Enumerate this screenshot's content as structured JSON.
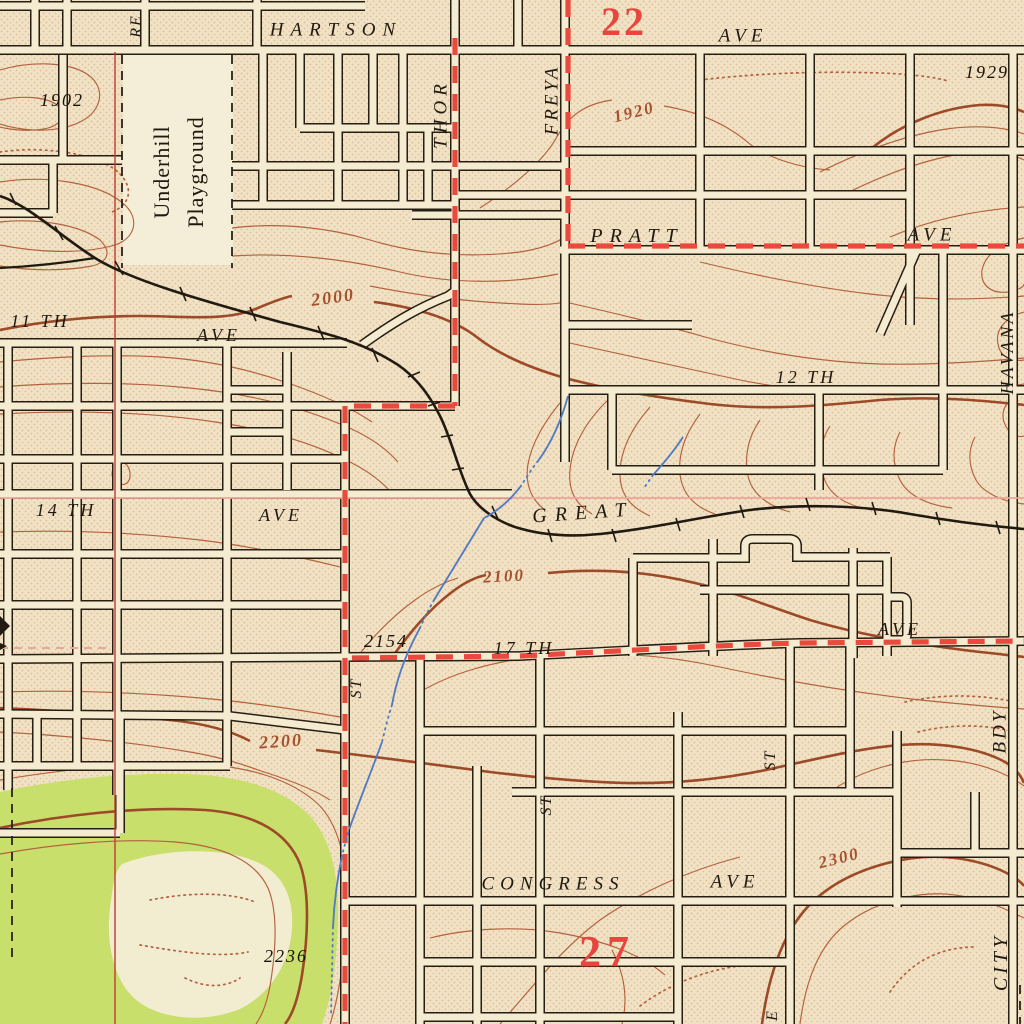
{
  "map": {
    "labels": {
      "re": "RE",
      "hartson": "HARTSON",
      "hartson_ave": "AVE",
      "thor": "THOR",
      "freya": "FREYA",
      "pratt": "PRATT",
      "pratt_ave": "AVE",
      "havana": "HAVANA",
      "eleventh": "11 TH",
      "eleventh_ave": "AVE",
      "twelfth": "12 TH",
      "fourteenth": "14 TH",
      "fourteenth_ave": "AVE",
      "great": "GREAT",
      "seventeenth": "17 TH",
      "seventeenth_ave": "AVE",
      "st1": "ST",
      "st2": "ST",
      "st3": "ST",
      "congress": "CONGRESS",
      "congress_ave": "AVE",
      "bdy": "BDY",
      "city": "CITY",
      "e_partial": "E",
      "underhill_line1": "Underhill",
      "underhill_line2": "Playground"
    },
    "spot_elevations": {
      "s1902": "1902",
      "s1929": "1929",
      "s2154": "2154",
      "s2236": "2236"
    },
    "contour_labels": {
      "c1920": "1920",
      "c2000": "2000",
      "c2100": "2100",
      "c2200": "2200",
      "c2300": "2300"
    },
    "section_numbers": {
      "s22": "22",
      "s27": "27"
    },
    "colors": {
      "paper": "#f0e2c4",
      "urban_tint_dot": "#d08b66",
      "street_ink": "#261e13",
      "street_fill": "#f5ebd1",
      "contour": "#b4613e",
      "contour_index": "#9c4a27",
      "water_blue": "#4e79c5",
      "woodland_green": "#c9df6c",
      "clearing": "#f2ecd0",
      "highway_red": "#ea4a3d",
      "section_red": "#e8453e",
      "land_line_red": "#c23a31",
      "section_line_pink": "#efa39a"
    }
  }
}
